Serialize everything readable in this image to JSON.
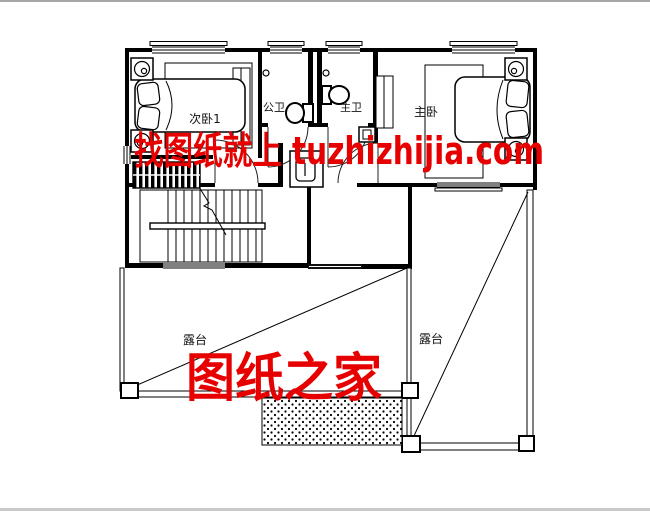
{
  "rooms": {
    "bedroom2": "次卧1",
    "public_bath": "公卫",
    "master_bath": "主卫",
    "master_bedroom": "主卧",
    "terrace_left": "露台",
    "terrace_right": "露台"
  },
  "watermark": {
    "tagline": "找图纸就上 tuzhizhijia.com",
    "brand": "图纸之家",
    "color": "#e60000"
  },
  "drawing": {
    "wall_color": "#000000",
    "background": "#ffffff",
    "frame_border": "#b9b9b9"
  }
}
